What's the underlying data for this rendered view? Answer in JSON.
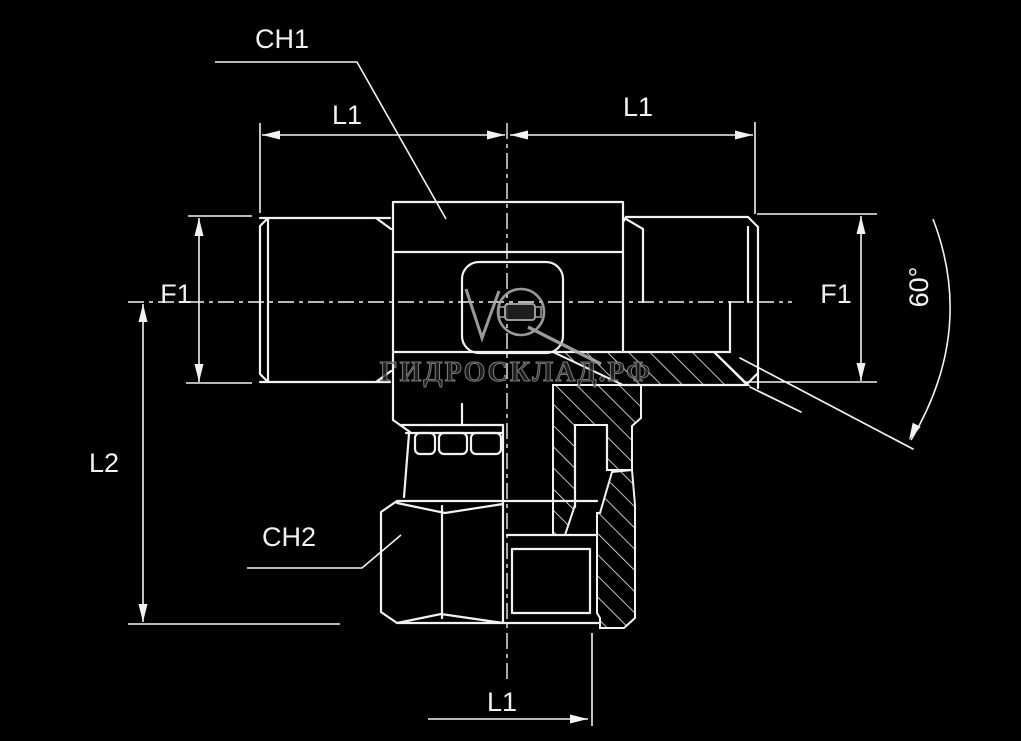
{
  "colors": {
    "background": "#000000",
    "line": "#f2f2f2",
    "watermark": "#9d9d9d"
  },
  "drawing": {
    "type": "technical-drawing-tee-fitting",
    "labels": {
      "ch1": "CH1",
      "ch2": "CH2",
      "l1_top_left": "L1",
      "l1_top_right": "L1",
      "l1_bottom": "L1",
      "f1_left": "F1",
      "f1_right": "F1",
      "l2": "L2",
      "angle": "60°"
    }
  },
  "watermark": {
    "text": "ГИДРОСКЛАД.РФ",
    "logo": "hydroscklad-fitting-logo"
  }
}
